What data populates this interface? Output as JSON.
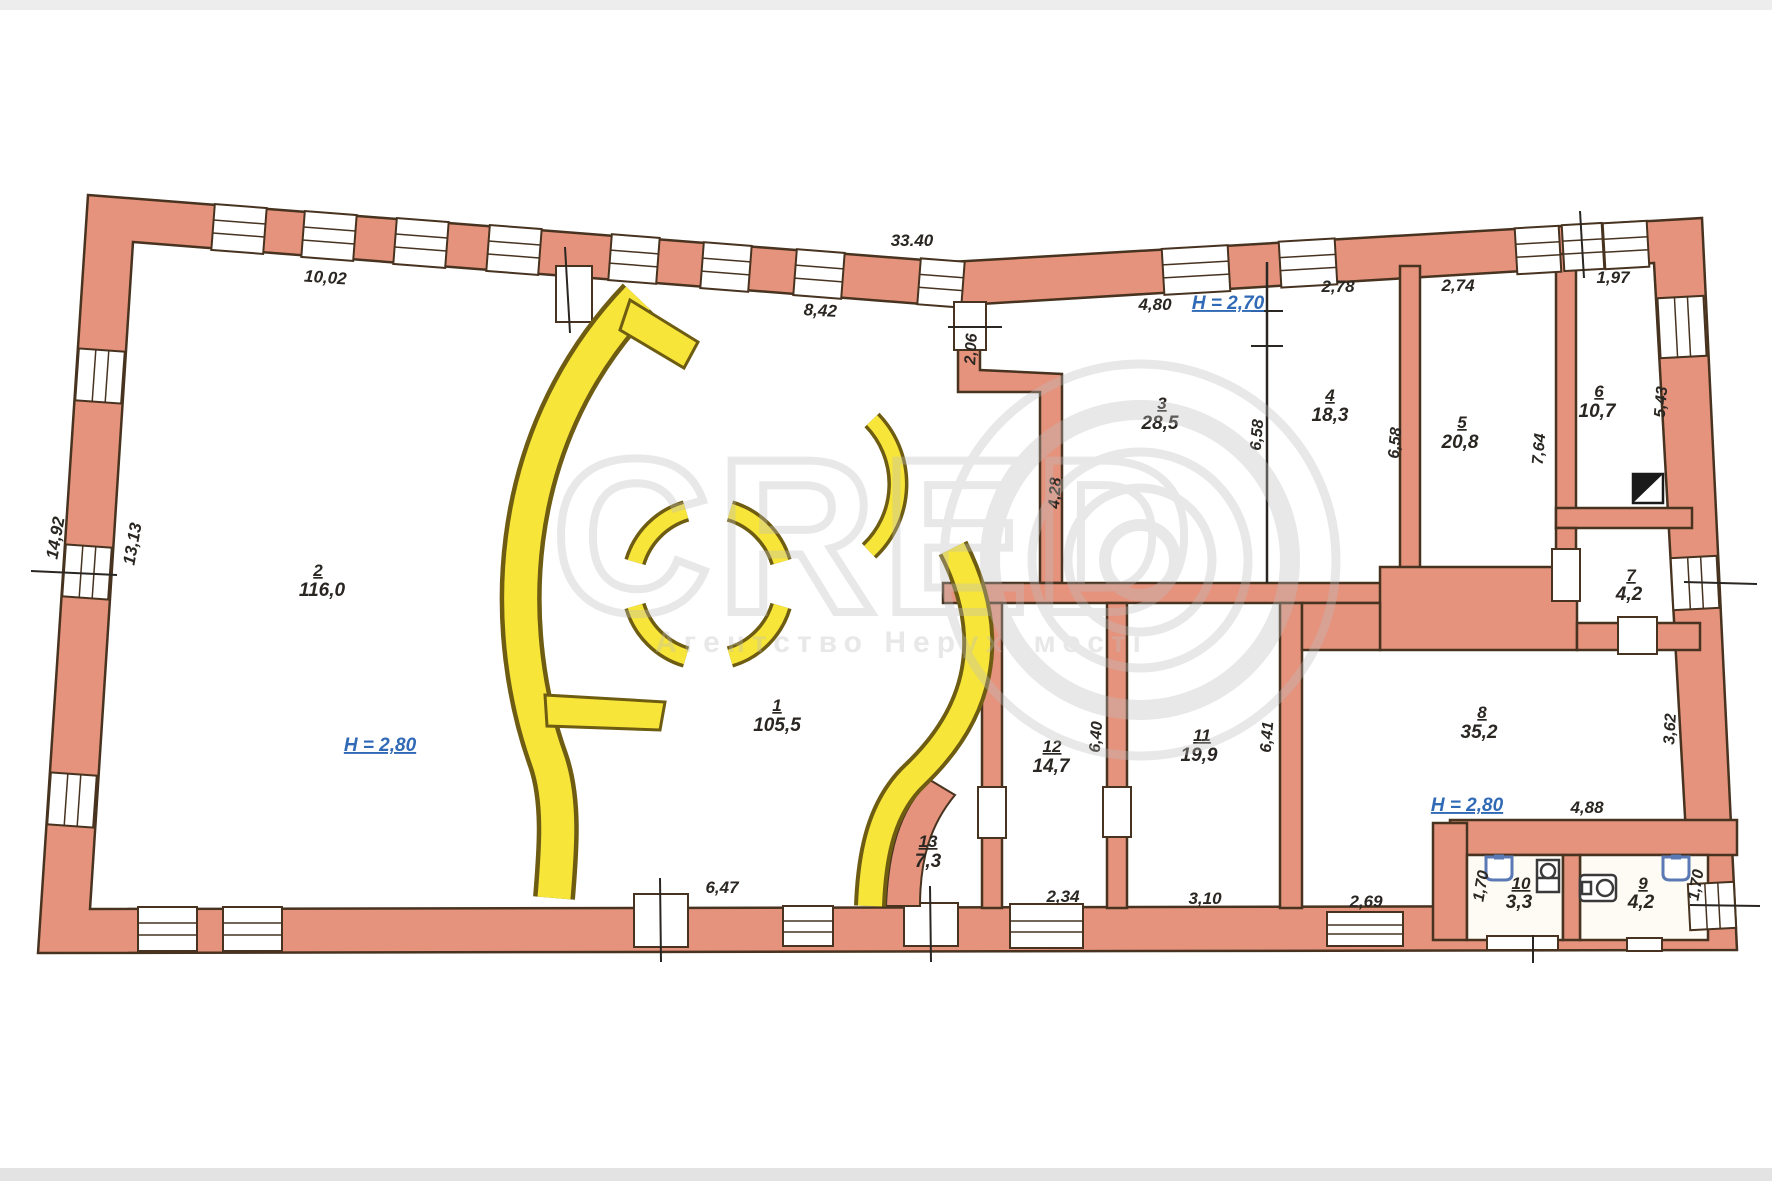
{
  "watermark": {
    "brand": "CRED",
    "subtitle": "Агентство Нерухомості"
  },
  "heights": {
    "room2": "H = 2,80",
    "top": "H = 2,70",
    "room8": "H = 2,80"
  },
  "rooms": [
    {
      "number": "1",
      "area": "105,5"
    },
    {
      "number": "2",
      "area": "116,0"
    },
    {
      "number": "3",
      "area": "28,5"
    },
    {
      "number": "4",
      "area": "18,3"
    },
    {
      "number": "5",
      "area": "20,8"
    },
    {
      "number": "6",
      "area": "10,7"
    },
    {
      "number": "7",
      "area": "4,2"
    },
    {
      "number": "8",
      "area": "35,2"
    },
    {
      "number": "9",
      "area": "4,2"
    },
    {
      "number": "10",
      "area": "3,3"
    },
    {
      "number": "11",
      "area": "19,9"
    },
    {
      "number": "12",
      "area": "14,7"
    },
    {
      "number": "13",
      "area": "7,3"
    }
  ],
  "dimensions": {
    "top_total": "33.40",
    "top_left": "10,02",
    "top_mid": "8,42",
    "left_outer": "14,92",
    "left_inner": "13,13",
    "bottom_left": "6,47",
    "hall_door": "2,06",
    "hall_wall": "4,28",
    "room3_width": "4,80",
    "room4_width": "2,78",
    "room5_width": "2,74",
    "room6_window": "1,97",
    "room3_depth": "6,58",
    "room4_depth": "6,58",
    "room5_depth": "7,64",
    "room6_depth": "5,43",
    "room8_right": "3,62",
    "room8_bottom": "4,88",
    "room8_window": "2,69",
    "room12_bottom": "2,34",
    "room11_bottom": "3,10",
    "room10_depth": "1,70",
    "room9_depth": "1,70",
    "room12_depth": "6,40",
    "room11_depth": "6,41"
  },
  "colors": {
    "wall_fill": "#e5937d",
    "wall_outline": "#47331f",
    "floor": "#fdfbf4",
    "partition_yellow": "#f7e53a",
    "yellow_outline": "#6e5c12",
    "dimension_text": "#2a2622",
    "height_text": "#3069b5",
    "watermark_gray": "#bdbdbd",
    "fixture_blue": "#5b7ab5"
  }
}
